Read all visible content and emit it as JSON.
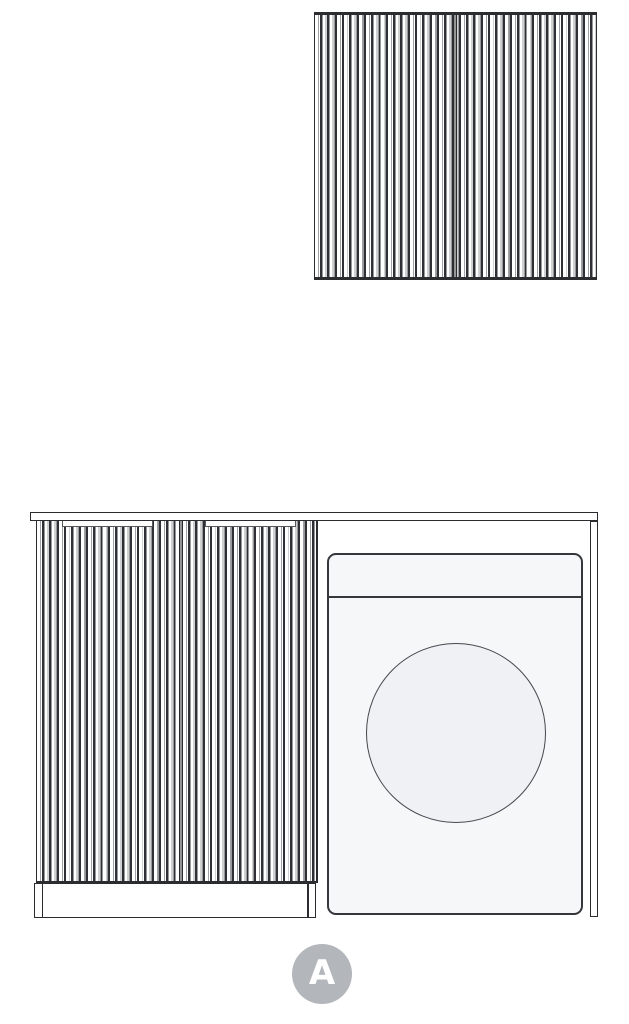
{
  "badge": {
    "label": "A"
  },
  "colors": {
    "outline": "#2b2c30",
    "flute_dark": "#2f3035",
    "flute_light": "#9ea1a6",
    "washer_body": "#f6f7f9",
    "washer_door_window": "#eff1f4",
    "panel_fill": "#ffffff",
    "badge_bg": "#b3b6ba",
    "badge_text": "#ffffff"
  },
  "styles": {
    "washer_body": "background:#f6f7f9",
    "washer_door": "background:#eff1f4",
    "badge": "background:#b3b6ba;color:#ffffff"
  },
  "icons": {
    "washer_door": "washing-machine-porthole-circle",
    "badge": "section-label-circle"
  }
}
